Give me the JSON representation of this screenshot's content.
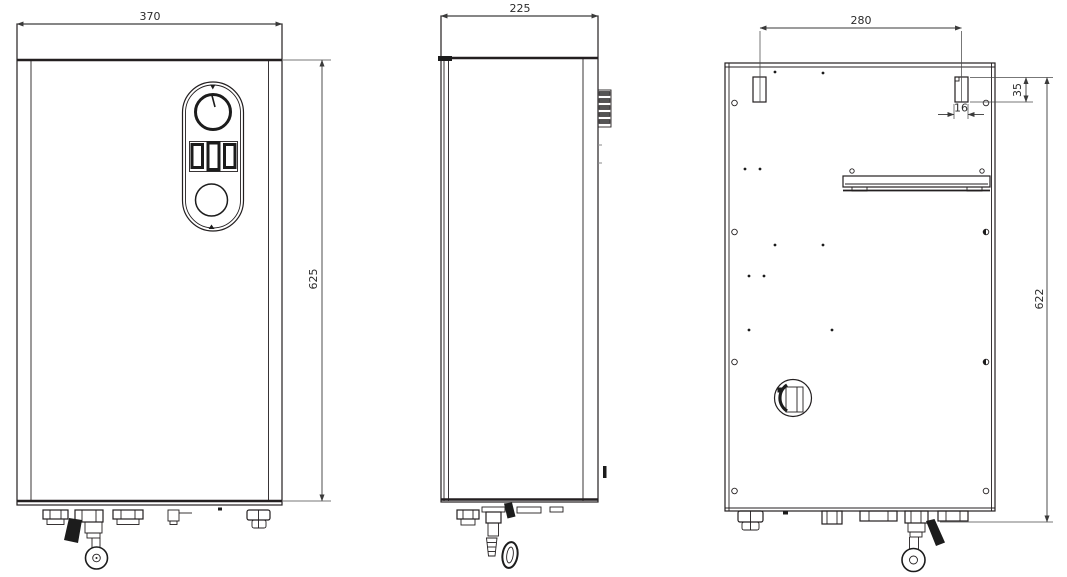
{
  "drawing": {
    "type": "technical-orthographic-drawing",
    "subject": "wall-mounted electric boiler, three views (front, side, back)",
    "colors": {
      "background": "#ffffff",
      "line": "#231f20",
      "dimension_text": "#2b2b2b"
    },
    "views": {
      "front": {
        "width_label": "370",
        "height_label": "625"
      },
      "side": {
        "depth_label": "225"
      },
      "back": {
        "slot_spacing_label": "280",
        "slot_height_label": "35",
        "slot_width_label": "16",
        "height_label": "622"
      }
    }
  }
}
